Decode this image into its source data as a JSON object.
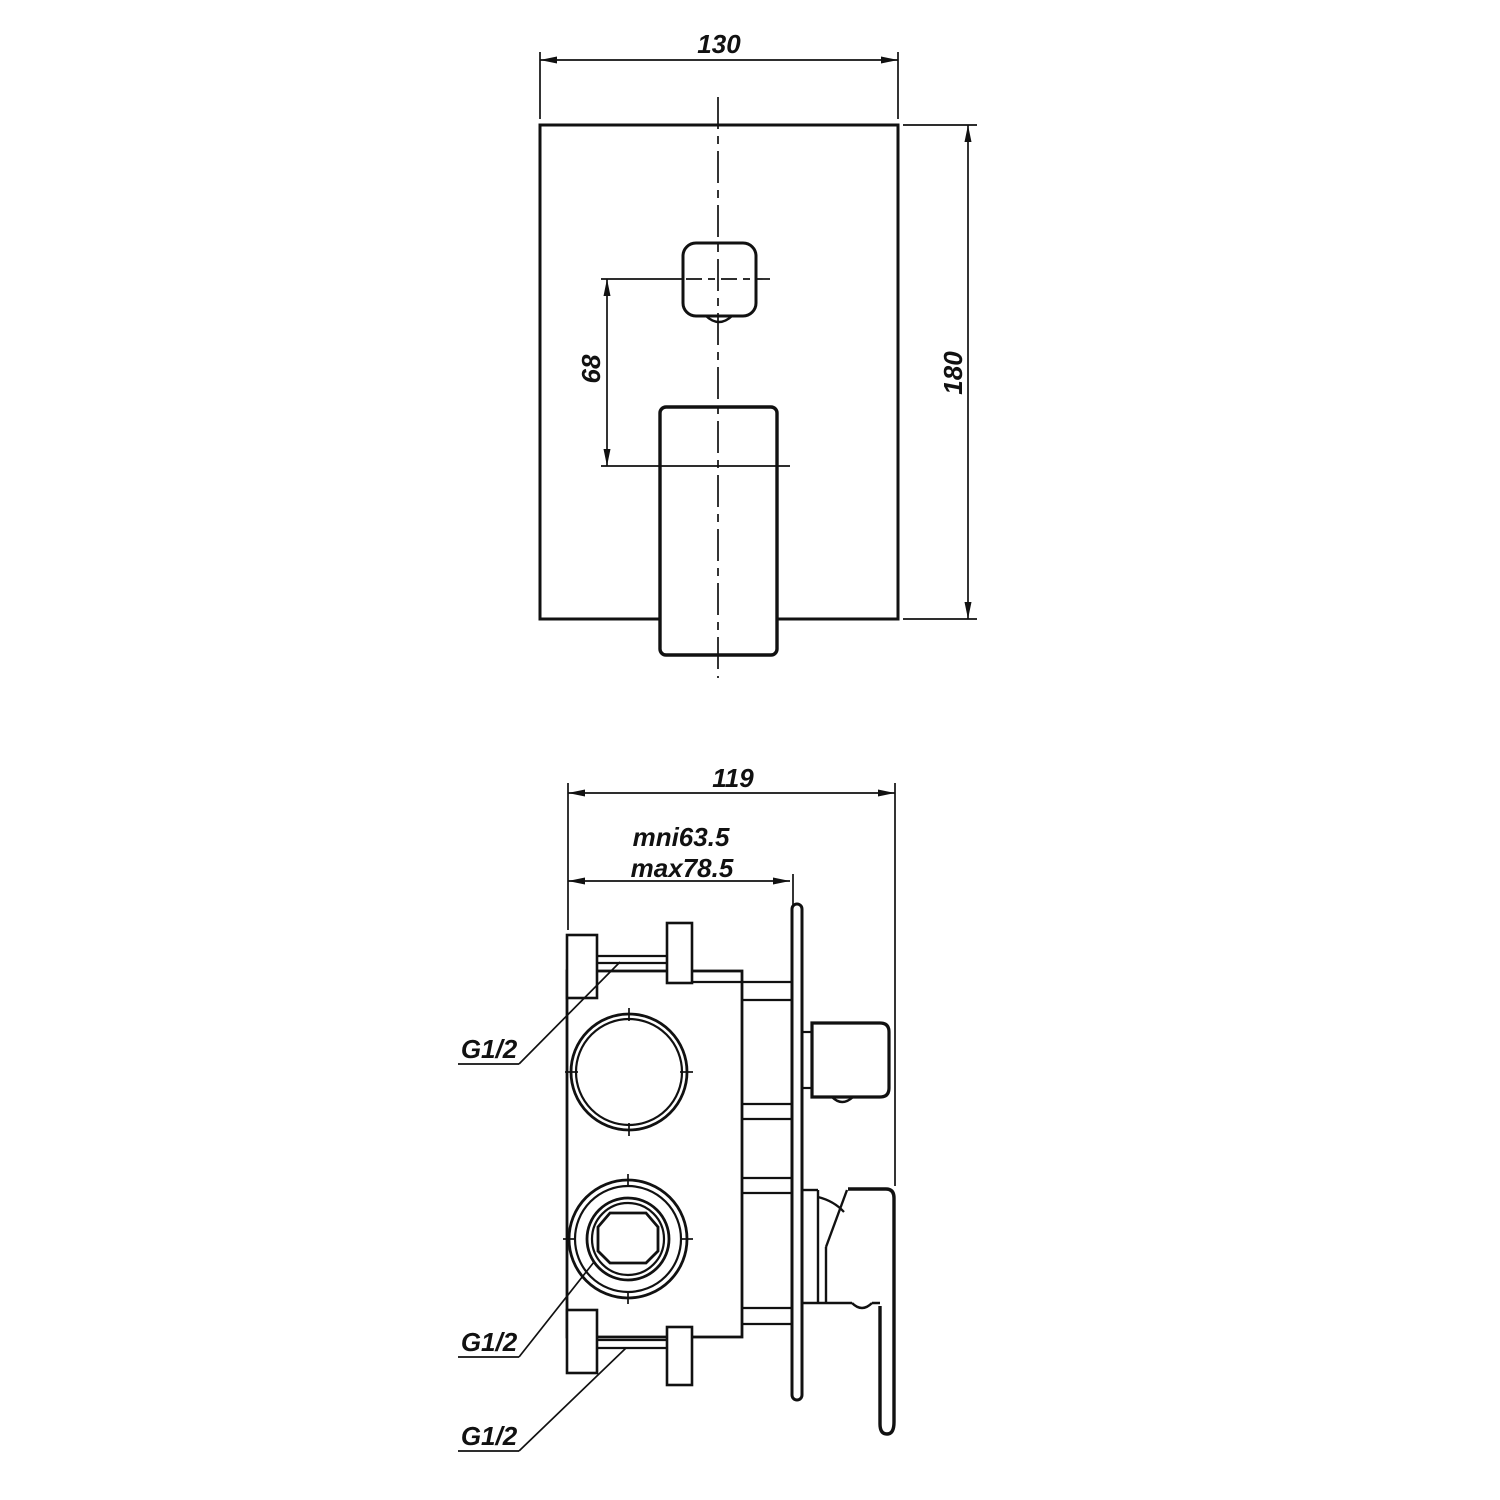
{
  "colors": {
    "background": "#ffffff",
    "line": "#111111"
  },
  "front_view": {
    "width_dim": "130",
    "height_dim": "180",
    "offset_dim": "68"
  },
  "side_view": {
    "depth_dim": "119",
    "min_depth_dim": "mni63.5",
    "max_depth_dim": "max78.5",
    "port_labels": [
      "G1/2",
      "G1/2",
      "G1/2"
    ]
  }
}
